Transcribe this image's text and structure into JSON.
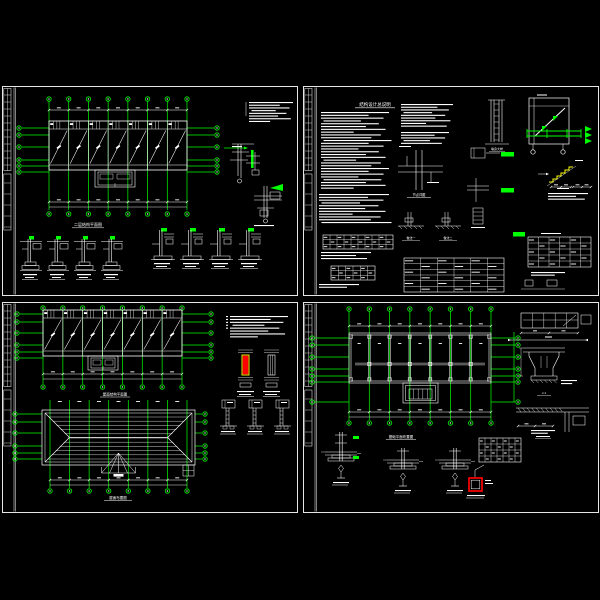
{
  "app": {
    "background": "#000000",
    "description": "CAD structural drawing set, 4 sheets"
  },
  "colors": {
    "line": "#ffffff",
    "axis": "#00ff00",
    "highlight": "#ff0000",
    "highlight_edge": "#ffff00",
    "stair": "#ffff00"
  },
  "sheets": {
    "tl": {
      "name": "second-floor-structural-plan-sheet",
      "plan_title": "二层结构平面图",
      "bays": 7,
      "grid_cols": 8,
      "grid_rows": 6,
      "column_details_left": 4,
      "column_details_right": 4
    },
    "tr": {
      "name": "general-notes-sheet",
      "title": "结构设计总说明",
      "joint_title": "节点详图",
      "base_title_a": "做法一",
      "base_title_b": "做法二",
      "wall_title": "墙身大样",
      "tables": 3
    },
    "bl": {
      "name": "roof-plans-sheet",
      "plan1_title": "屋面结构平面图",
      "plan2_title": "屋面布置图",
      "bays": 7,
      "grid_cols": 8
    },
    "br": {
      "name": "foundation-plan-sheet",
      "plan_title": "基础平面布置图",
      "detail_j1": "J-1",
      "bays": 7,
      "grid_cols": 8,
      "foundation_sections": 3
    }
  }
}
